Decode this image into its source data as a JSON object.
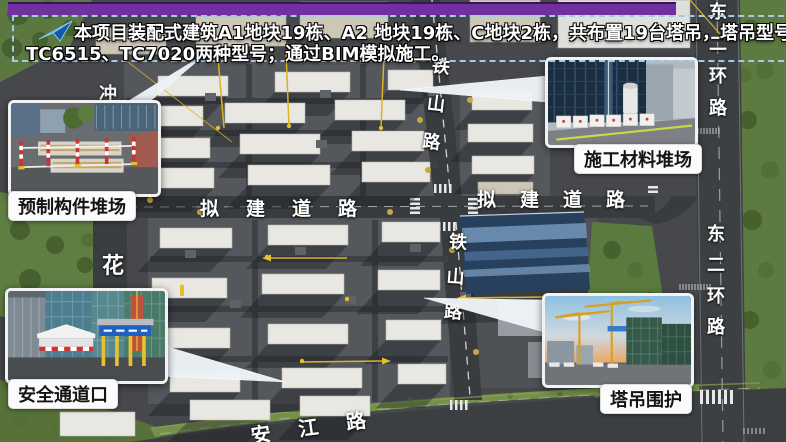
{
  "banner": {
    "line1": "本项目装配式建筑A1地块19栋、A2 地块19栋、C地块2栋，共布置19台塔吊，塔吊型号主要使用",
    "line2": "TC6515、TC7020两种型号；通过BIM模拟施工。",
    "icon": "flow-arrow-icon",
    "border_color": "#A6C9E8",
    "bar_color": "#7030A0"
  },
  "callouts": {
    "precast_yard": {
      "label": "预制构件堆场"
    },
    "material_yard": {
      "label": "施工材料堆场"
    },
    "safety_passage": {
      "label": "安全通道口"
    },
    "crane_enclosure": {
      "label": "塔吊围护"
    }
  },
  "roads": {
    "tieshan": "铁山路",
    "proposed": "拟建道路",
    "dongerhuan": "东二环路",
    "hua_char": "花",
    "chong_char": "冲",
    "anjiang": "安江路"
  },
  "colors": {
    "pointer": "#EEF3F8",
    "label_pill_bg": "#FBFBFB",
    "road_label_text": "#FFFFFF",
    "construction_yellow": "#DDB223",
    "site_asphalt": "#46484C",
    "greenery": "#5A7A3E"
  }
}
